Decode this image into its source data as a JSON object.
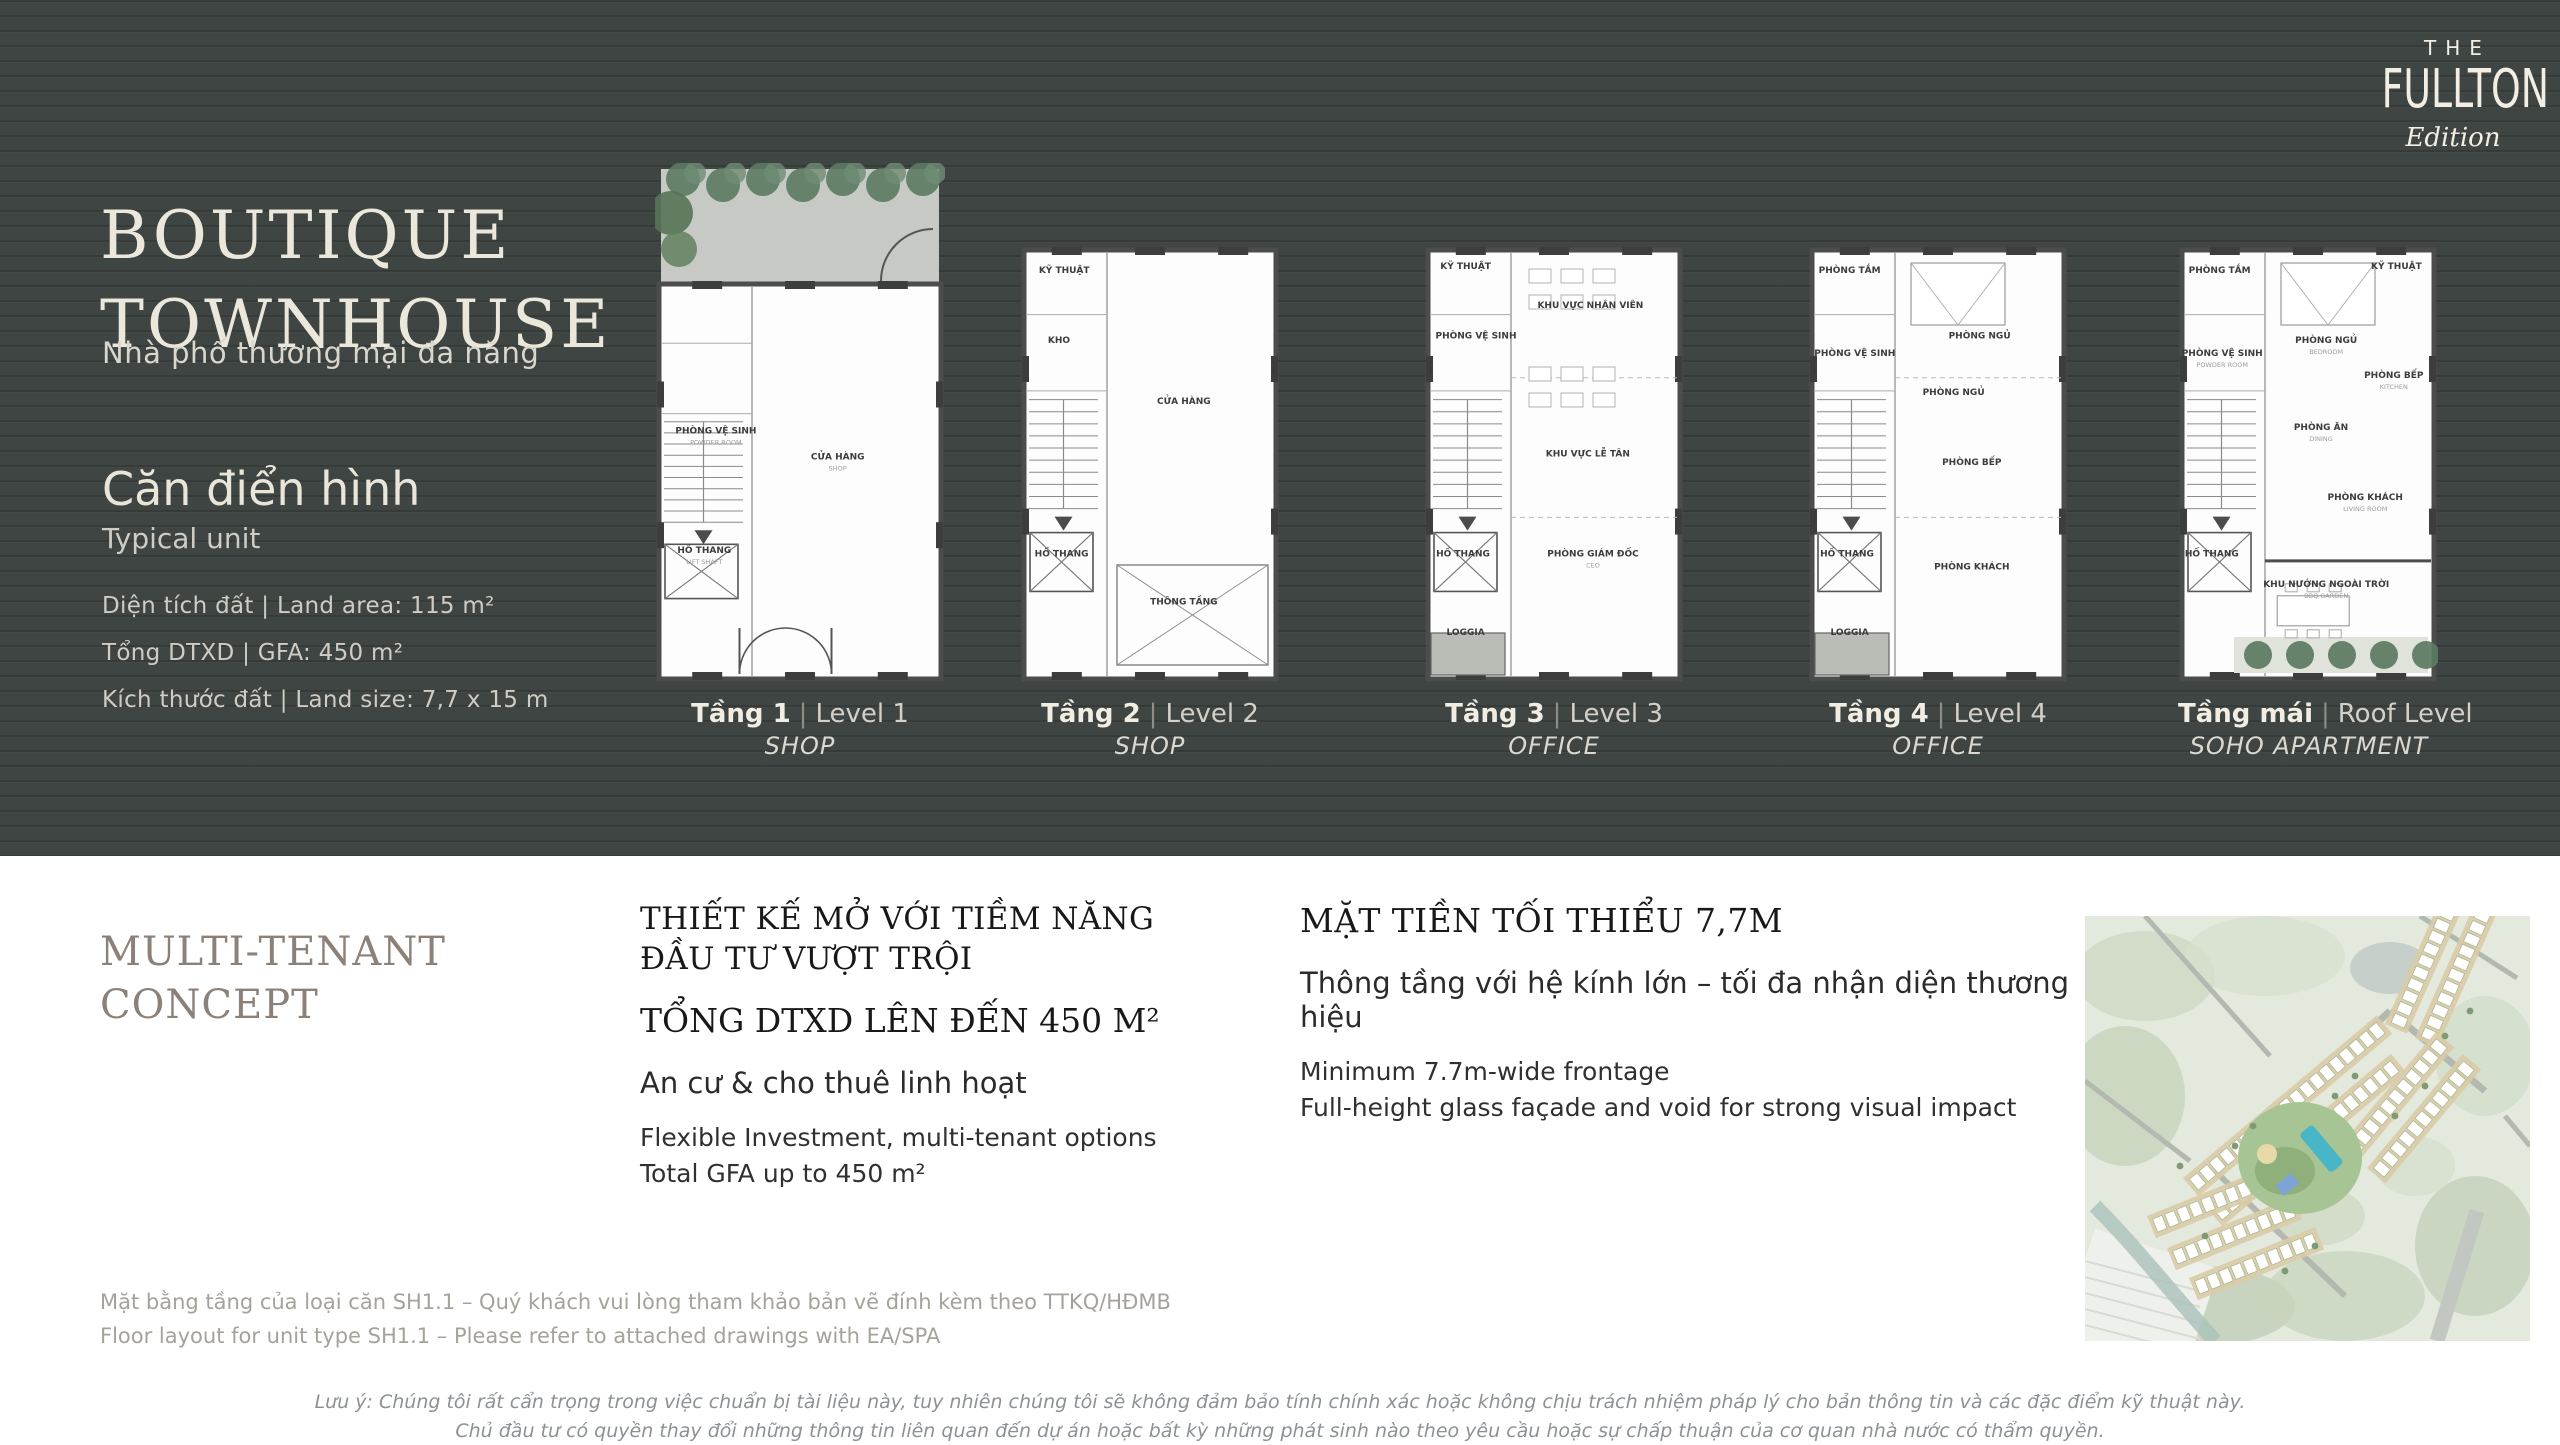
{
  "brand": {
    "top": "THE",
    "main": "FULLTON",
    "script": "Edition"
  },
  "hero": {
    "title_line1": "BOUTIQUE",
    "title_line2": "TOWNHOUSE",
    "subtitle": "Nhà phố thương mại đa năng",
    "unit_title": "Căn điển hình",
    "unit_subtitle": "Typical unit",
    "specs": [
      "Diện tích đất | Land area:  115 m²",
      "Tổng DTXD | GFA: 450 m²",
      "Kích thước đất | Land size: 7,7 x 15 m"
    ]
  },
  "plan_caption_sep": "|",
  "plans": [
    {
      "name_vi": "Tầng 1",
      "name_en": "Level 1",
      "use": "SHOP",
      "features": [
        "garden_top",
        "stairs",
        "lift",
        "entry_doors"
      ],
      "rooms": [
        {
          "label": "CỬA HÀNG",
          "sub": "SHOP",
          "x": 63,
          "y": 57
        },
        {
          "label": "PHÒNG VỆ SINH",
          "sub": "POWDER ROOM",
          "x": 21,
          "y": 52
        },
        {
          "label": "HỐ THANG",
          "sub": "LIFT SHAFT",
          "x": 17,
          "y": 75
        }
      ]
    },
    {
      "name_vi": "Tầng 2",
      "name_en": "Level 2",
      "use": "SHOP",
      "features": [
        "stairs",
        "lift",
        "void_x"
      ],
      "rooms": [
        {
          "label": "KỸ THUẬT",
          "x": 17,
          "y": 6
        },
        {
          "label": "KHO",
          "x": 15,
          "y": 22
        },
        {
          "label": "CỬA HÀNG",
          "x": 63,
          "y": 36
        },
        {
          "label": "HỐ THANG",
          "x": 16,
          "y": 71
        },
        {
          "label": "THÔNG TẦNG",
          "x": 63,
          "y": 82
        }
      ]
    },
    {
      "name_vi": "Tầng 3",
      "name_en": "Level 3",
      "use": "OFFICE",
      "features": [
        "stairs",
        "lift",
        "loggia",
        "office_desks",
        "zones"
      ],
      "rooms": [
        {
          "label": "KỸ THUẬT",
          "x": 16,
          "y": 5
        },
        {
          "label": "PHÒNG VỆ SINH",
          "x": 20,
          "y": 21
        },
        {
          "label": "KHU VỰC NHÂN VIÊN",
          "x": 64,
          "y": 14
        },
        {
          "label": "KHU VỰC LỄ TÂN",
          "x": 63,
          "y": 48
        },
        {
          "label": "PHÒNG GIÁM ĐỐC",
          "sub": "CEO",
          "x": 65,
          "y": 71
        },
        {
          "label": "HỐ THANG",
          "x": 15,
          "y": 71
        },
        {
          "label": "LOGGIA",
          "x": 16,
          "y": 89
        }
      ]
    },
    {
      "name_vi": "Tầng 4",
      "name_en": "Level 4",
      "use": "OFFICE",
      "features": [
        "stairs",
        "lift",
        "loggia",
        "bed",
        "zones"
      ],
      "rooms": [
        {
          "label": "PHÒNG TẮM",
          "x": 16,
          "y": 6
        },
        {
          "label": "PHÒNG NGỦ",
          "x": 66,
          "y": 21
        },
        {
          "label": "PHÒNG VỆ SINH",
          "x": 18,
          "y": 25
        },
        {
          "label": "PHÒNG NGỦ",
          "x": 56,
          "y": 34
        },
        {
          "label": "PHÒNG BẾP",
          "x": 63,
          "y": 50
        },
        {
          "label": "PHÒNG KHÁCH",
          "x": 63,
          "y": 74
        },
        {
          "label": "HỐ THANG",
          "x": 15,
          "y": 71
        },
        {
          "label": "LOGGIA",
          "x": 16,
          "y": 89
        }
      ]
    },
    {
      "name_vi": "Tầng mái",
      "name_en": "Roof Level",
      "use": "SOHO APARTMENT",
      "features": [
        "stairs",
        "lift",
        "bed",
        "garden_bottom"
      ],
      "rooms": [
        {
          "label": "PHÒNG TẮM",
          "x": 16,
          "y": 6
        },
        {
          "label": "PHÒNG NGỦ",
          "sub": "BEDROOM",
          "x": 57,
          "y": 22
        },
        {
          "label": "KỸ THUẬT",
          "x": 84,
          "y": 5
        },
        {
          "label": "PHÒNG VỆ SINH",
          "sub": "POWDER ROOM",
          "x": 17,
          "y": 25
        },
        {
          "label": "PHÒNG BẾP",
          "sub": "KITCHEN",
          "x": 83,
          "y": 30
        },
        {
          "label": "PHÒNG ĂN",
          "sub": "DINING",
          "x": 55,
          "y": 42
        },
        {
          "label": "PHÒNG KHÁCH",
          "sub": "LIVING ROOM",
          "x": 72,
          "y": 58
        },
        {
          "label": "HỐ THANG",
          "x": 13,
          "y": 71
        },
        {
          "label": "KHU NƯỚNG NGOÀI TRỜI",
          "sub": "BBQ GARDEN",
          "x": 57,
          "y": 78
        }
      ]
    }
  ],
  "concept": {
    "heading_line1": "MULTI-TENANT",
    "heading_line2": "CONCEPT",
    "col1": {
      "heading_line1": "THIẾT KẾ MỞ VỚI TIỀM NĂNG",
      "heading_line2": "ĐẦU TƯ VƯỢT TRỘI",
      "total_line": "TỔNG DTXD LÊN ĐẾN 450 M²",
      "vi_line": "An cư &  cho thuê linh hoạt",
      "en_line1": "Flexible Investment, multi-tenant options",
      "en_line2": "Total GFA up to 450 m²"
    },
    "col2": {
      "heading": "MẶT TIỀN TỐI THIỂU 7,7M",
      "vi_line": "Thông tầng với hệ kính lớn – tối đa nhận diện thương hiệu",
      "en_line1": "Minimum 7.7m-wide frontage",
      "en_line2": "Full-height glass façade and void for strong visual impact"
    }
  },
  "footnote_line1": "Mặt bằng tầng của loại căn SH1.1 – Quý khách vui lòng tham khảo bản vẽ đính kèm theo TTKQ/HĐMB",
  "footnote_line2": "Floor layout for unit type SH1.1 – Please refer to  attached drawings with EA/SPA",
  "disclaimer_line1": "Lưu ý: Chúng tôi rất cẩn trọng trong việc chuẩn bị tài liệu này, tuy nhiên chúng tôi sẽ không đảm bảo tính chính xác hoặc không chịu trách nhiệm pháp lý cho bản thông tin và các đặc điểm kỹ thuật này.",
  "disclaimer_line2": "Chủ đầu tư có quyền thay đổi những thông tin liên quan đến dự án hoặc bất kỳ những phát sinh nào theo yêu cầu hoặc sự chấp thuận của cơ quan nhà nước có thẩm quyền.",
  "colors": {
    "dark_bg": "#3f4543",
    "cream": "#ece7db",
    "taupe_heading": "#8b8178",
    "body_dark": "#1f1f1f",
    "muted_gray": "#a5a19b",
    "disclaimer_gray": "#8d9194"
  }
}
